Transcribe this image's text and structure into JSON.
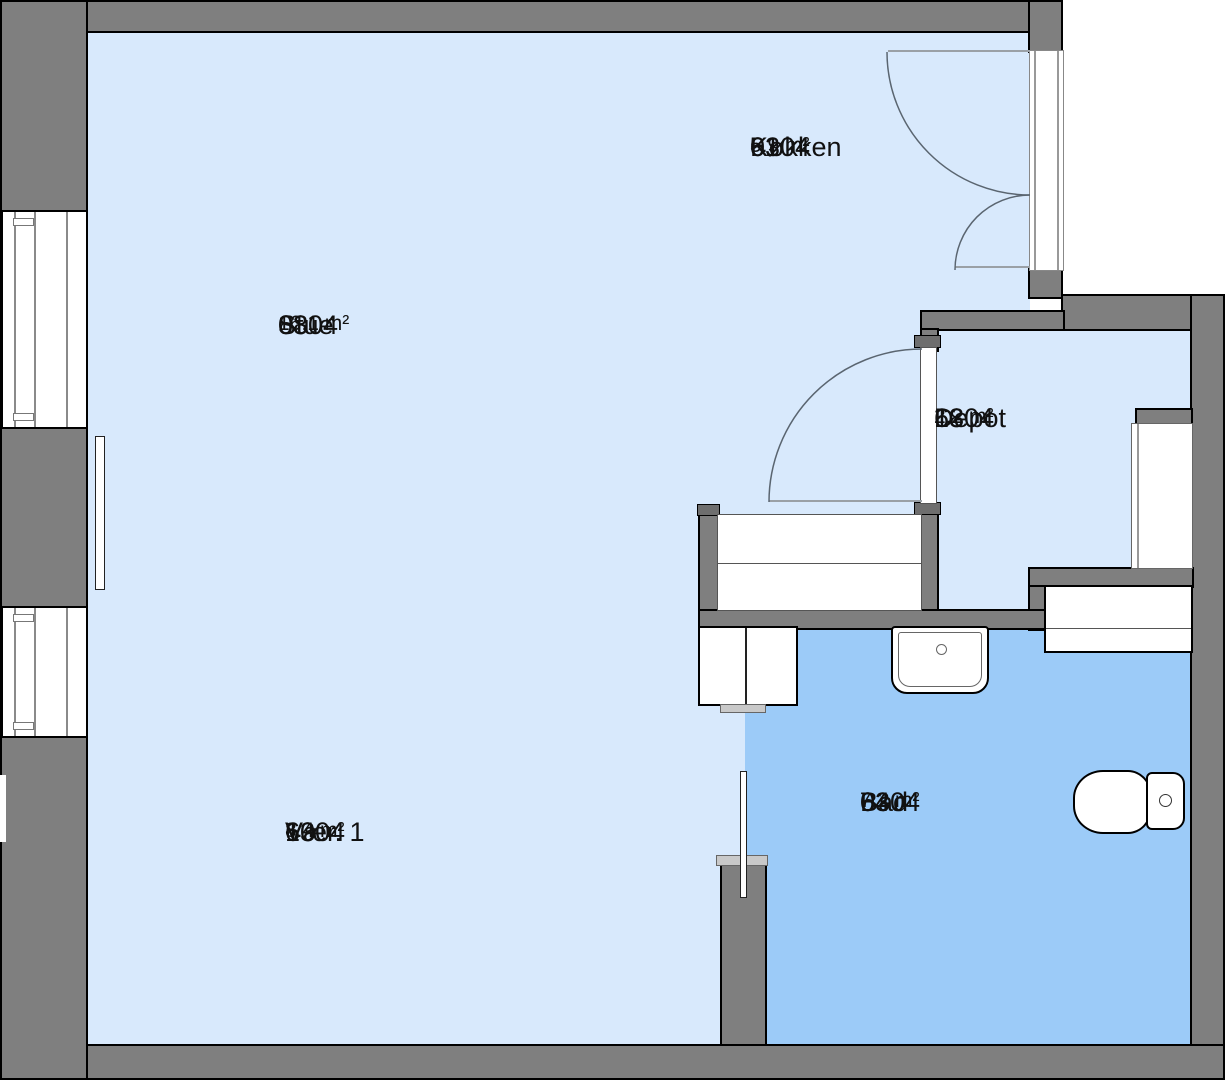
{
  "rooms": [
    {
      "number": "6304",
      "sub": "01",
      "name": "Køkken",
      "area": "5.9 m²"
    },
    {
      "number": "6304",
      "sub": "08",
      "name": "Stue",
      "area": "16.1 m²"
    },
    {
      "number": "6304",
      "sub": "18",
      "name": "Depot",
      "area": "2.2 m²"
    },
    {
      "number": "6304",
      "sub": "10",
      "name": "Vær. 1",
      "area": "8.4 m²"
    },
    {
      "number": "6304",
      "sub": "04",
      "name": "Bad",
      "area": "7.2 m²"
    }
  ],
  "colors": {
    "outside": "#FFFFFF",
    "floor_light": "#D8E9FC",
    "floor_bath": "#9CCBF8",
    "wall": "#7F7F7F",
    "outline": "#000000",
    "jamb": "#6E6E6E",
    "cap": "#C9C9C9",
    "arc": "#5A6570"
  }
}
